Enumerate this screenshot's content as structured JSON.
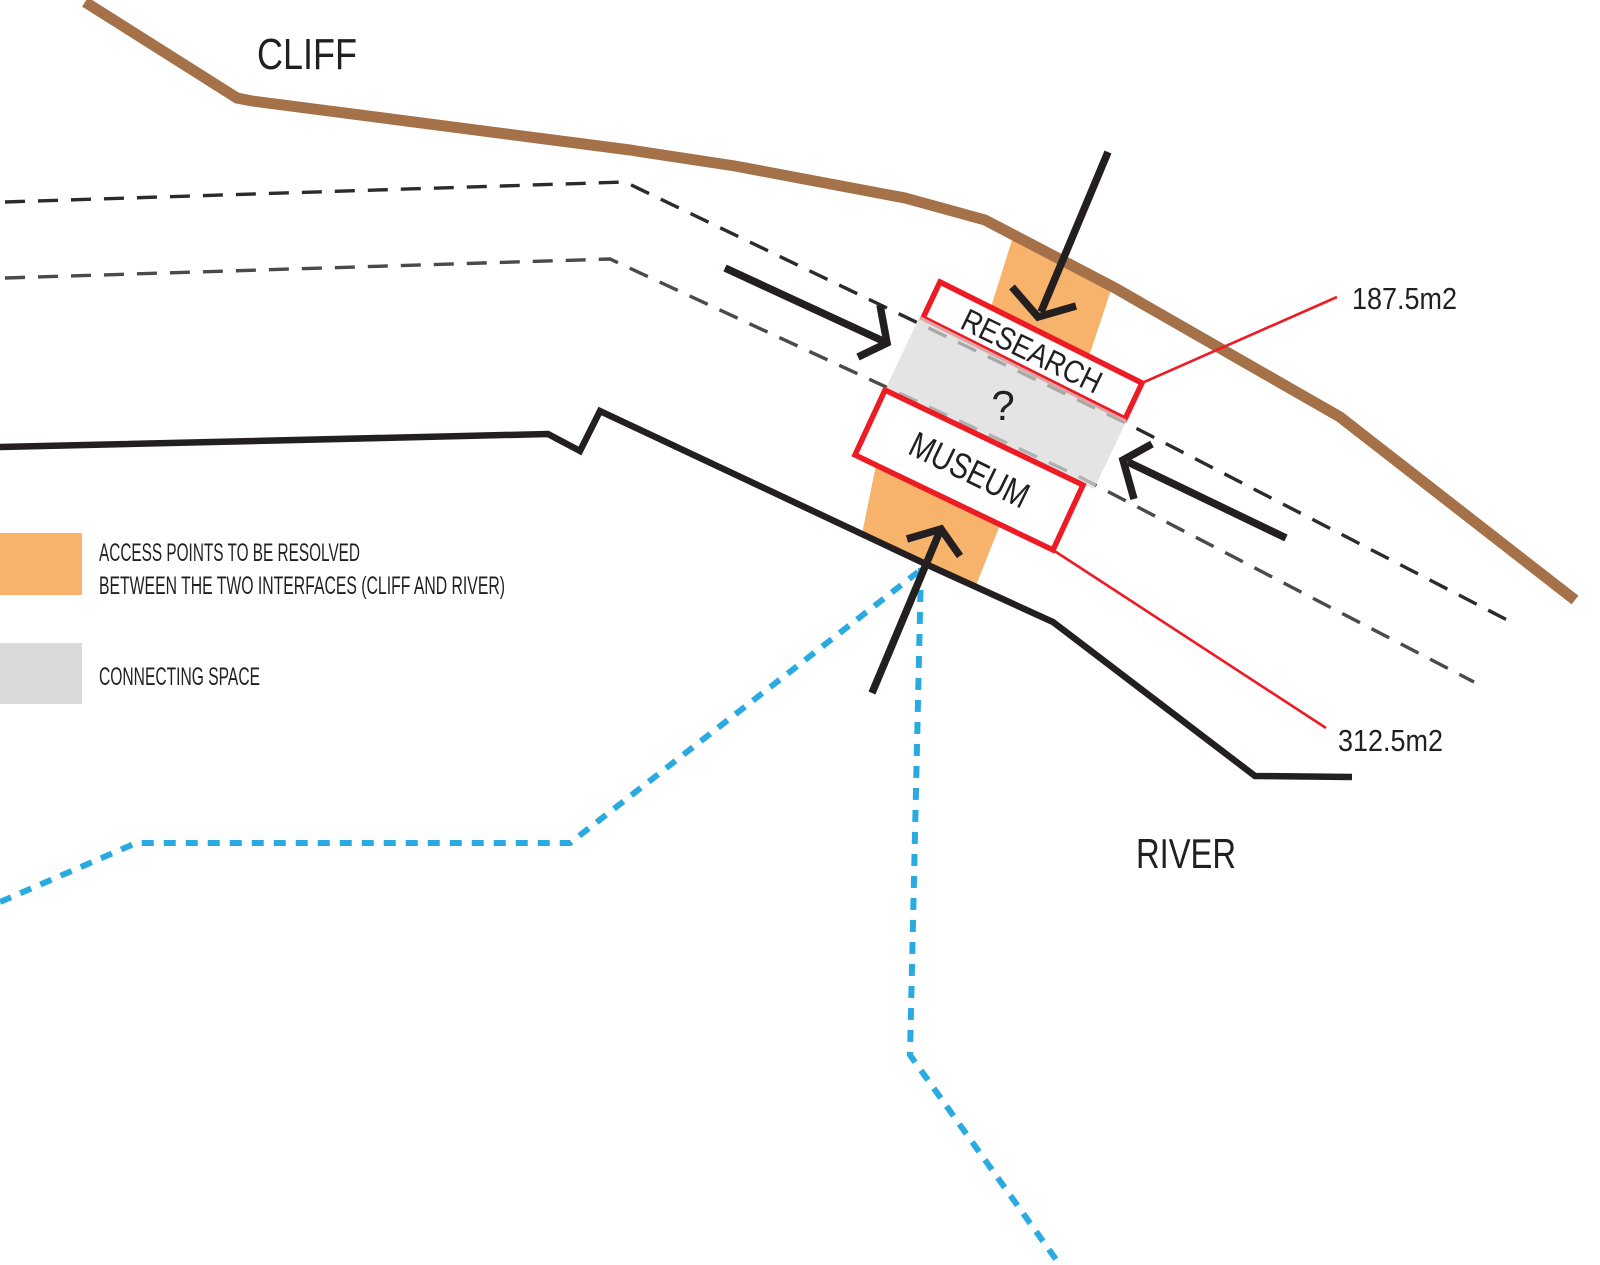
{
  "diagram": {
    "labels": {
      "cliff": "CLIFF",
      "river": "RIVER",
      "research": "RESEARCH",
      "museum": "MUSEUM",
      "connecting_question": "?",
      "research_area": "187.5m2",
      "museum_area": "312.5m2"
    },
    "legend": {
      "access_line1": "ACCESS POINTS TO BE RESOLVED",
      "access_line2": "BETWEEN THE TWO INTERFACES (CLIFF AND RIVER)",
      "connecting": "CONNECTING SPACE"
    },
    "colors": {
      "red": "#EC1B24",
      "brown": "#A57148",
      "orange": "#F7B36C",
      "grey_band": "#D9D9D9",
      "blue": "#29ABE2",
      "ink": "#231F20",
      "dash_dark": "#2B2B2B",
      "dash_mid": "#4A4A49"
    }
  }
}
